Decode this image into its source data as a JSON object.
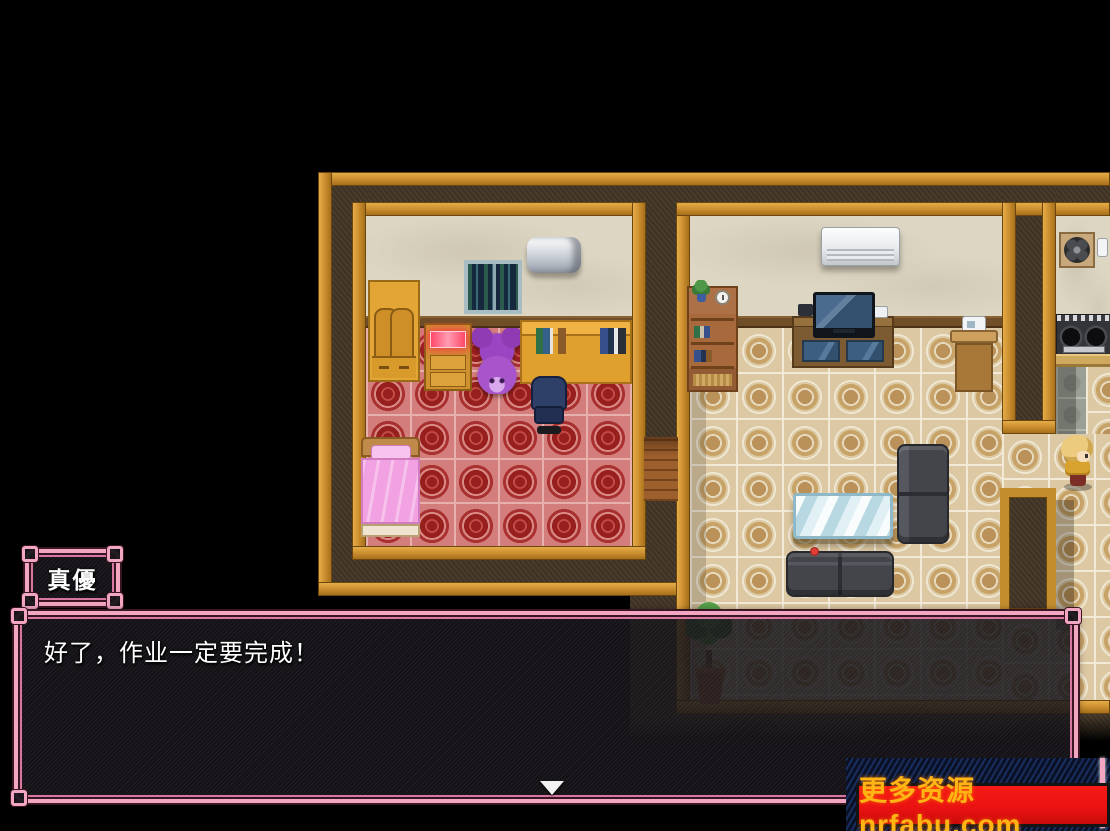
{
  "dialogue": {
    "speaker_name": "真優",
    "message": "好了，作业一定要完成！"
  },
  "watermark": {
    "text": "更多资源nrfabu.com"
  },
  "colors": {
    "accent_pink": "#f2a6c2",
    "inner_pink": "#d878a2",
    "dialogue_text": "#ffffff",
    "watermark_bg": "#e91212",
    "watermark_text": "#ffb514"
  }
}
